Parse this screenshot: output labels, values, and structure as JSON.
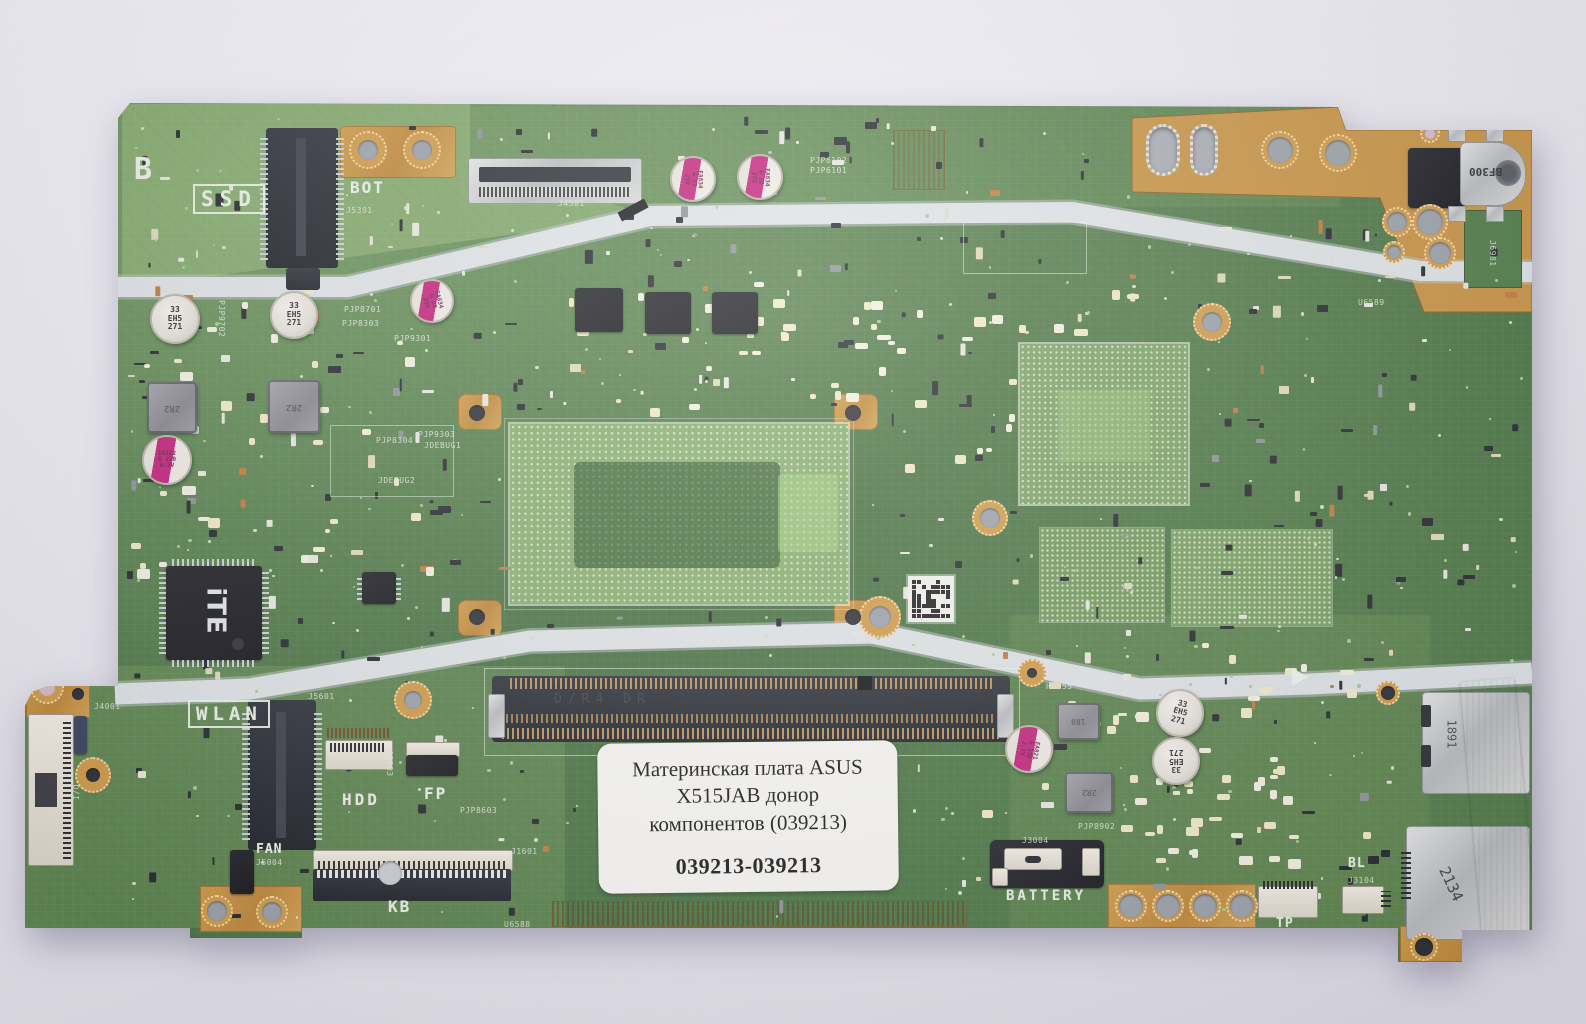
{
  "photo": {
    "background_top": "#f1f0f6",
    "background_bottom": "#dddbe4",
    "pcb_green": "#4a7342",
    "copper": "#c6913f",
    "band_metal": "#dde2e4"
  },
  "label": {
    "line1": "Материнская плата ASUS",
    "line2": "X515JAB донор",
    "line3": "компонентов (039213)",
    "code": "039213-039213"
  },
  "markings": {
    "dc_jack": "BF300",
    "usb_top": "1891",
    "usb_bottom": "2134",
    "ec_logo": "iTE",
    "ram": "D/R4 DR"
  },
  "silkscreen": {
    "big": [
      {
        "text": "B",
        "x": 134,
        "y": 152,
        "size": 30,
        "ls": 0,
        "box": false,
        "rot": 0
      },
      {
        "text": "SSD",
        "x": 193,
        "y": 184,
        "size": 21,
        "ls": 6,
        "box": true,
        "rot": 0
      },
      {
        "text": "BOT",
        "x": 350,
        "y": 178,
        "size": 16,
        "ls": 2,
        "box": false,
        "rot": 0
      },
      {
        "text": "WLAN",
        "x": 188,
        "y": 700,
        "size": 19,
        "ls": 5,
        "box": true,
        "rot": 0
      },
      {
        "text": "HDD",
        "x": 342,
        "y": 790,
        "size": 16,
        "ls": 3,
        "box": false,
        "rot": 0
      },
      {
        "text": "FP",
        "x": 424,
        "y": 784,
        "size": 16,
        "ls": 2,
        "box": false,
        "rot": 0
      },
      {
        "text": "KB",
        "x": 388,
        "y": 897,
        "size": 16,
        "ls": 2,
        "box": false,
        "rot": 0
      },
      {
        "text": "FAN",
        "x": 256,
        "y": 842,
        "size": 13,
        "ls": 1,
        "box": false,
        "rot": 0
      },
      {
        "text": "BATTERY",
        "x": 1006,
        "y": 888,
        "size": 14,
        "ls": 3,
        "box": false,
        "rot": 0
      },
      {
        "text": "TP",
        "x": 1276,
        "y": 916,
        "size": 13,
        "ls": 1,
        "box": false,
        "rot": 0
      },
      {
        "text": "BL",
        "x": 1348,
        "y": 856,
        "size": 13,
        "ls": 1,
        "box": false,
        "rot": 0
      }
    ],
    "refdes": [
      {
        "text": "J5301",
        "x": 346,
        "y": 206,
        "rot": 0
      },
      {
        "text": "J4501",
        "x": 558,
        "y": 199,
        "rot": 0
      },
      {
        "text": "PJP6102",
        "x": 810,
        "y": 156,
        "rot": 0
      },
      {
        "text": "PJP6101",
        "x": 810,
        "y": 166,
        "rot": 0
      },
      {
        "text": "PJP8201",
        "x": 402,
        "y": 264,
        "rot": 0
      },
      {
        "text": "PJP8701",
        "x": 344,
        "y": 305,
        "rot": 0
      },
      {
        "text": "PJP8303",
        "x": 342,
        "y": 319,
        "rot": 0
      },
      {
        "text": "PJP9301",
        "x": 394,
        "y": 334,
        "rot": 0
      },
      {
        "text": "PJP9702",
        "x": 226,
        "y": 300,
        "rot": 90
      },
      {
        "text": "PJP8304",
        "x": 376,
        "y": 436,
        "rot": 0
      },
      {
        "text": "PJP9303",
        "x": 418,
        "y": 430,
        "rot": 0
      },
      {
        "text": "JDEBUG1",
        "x": 424,
        "y": 441,
        "rot": 0
      },
      {
        "text": "JDEBUG2",
        "x": 378,
        "y": 476,
        "rot": 0
      },
      {
        "text": "J4001",
        "x": 94,
        "y": 702,
        "rot": 0
      },
      {
        "text": "I/O",
        "x": 72,
        "y": 800,
        "rot": -90
      },
      {
        "text": "J5601",
        "x": 308,
        "y": 692,
        "rot": 0
      },
      {
        "text": "J3103",
        "x": 394,
        "y": 750,
        "rot": 90
      },
      {
        "text": "PJP8603",
        "x": 460,
        "y": 806,
        "rot": 0
      },
      {
        "text": "J5004",
        "x": 256,
        "y": 858,
        "rot": 0
      },
      {
        "text": "J1601",
        "x": 511,
        "y": 847,
        "rot": 0
      },
      {
        "text": "U6588",
        "x": 504,
        "y": 920,
        "rot": 0
      },
      {
        "text": "H6555",
        "x": 1046,
        "y": 682,
        "rot": 0
      },
      {
        "text": "H6557",
        "x": 1196,
        "y": 230,
        "rot": 0
      },
      {
        "text": "U6589",
        "x": 1358,
        "y": 298,
        "rot": 0
      },
      {
        "text": "PJP8902",
        "x": 1078,
        "y": 822,
        "rot": 0
      },
      {
        "text": "J3004",
        "x": 1022,
        "y": 836,
        "rot": 0
      },
      {
        "text": "J3104",
        "x": 1348,
        "y": 876,
        "rot": 0
      },
      {
        "text": "J6981",
        "x": 1497,
        "y": 240,
        "rot": 90
      }
    ]
  },
  "components": {
    "caps": [
      {
        "x": 691,
        "y": 177,
        "r": 21,
        "type": "pink",
        "lines": [
          "EA834",
          "G 22",
          "25V"
        ],
        "rot": 90
      },
      {
        "x": 758,
        "y": 175,
        "r": 21,
        "type": "pink",
        "lines": [
          "EA834",
          "G 22",
          "25V"
        ],
        "rot": 90
      },
      {
        "x": 430,
        "y": 299,
        "r": 20,
        "type": "pink",
        "lines": [
          "EA834",
          "G 22",
          "25V"
        ],
        "rot": 75
      },
      {
        "x": 165,
        "y": 458,
        "r": 23,
        "type": "pink",
        "lines": [
          "EA322",
          "G 220",
          "6.3V"
        ],
        "rot": 0
      },
      {
        "x": 1027,
        "y": 747,
        "r": 22,
        "type": "pink",
        "lines": [
          "EA821",
          "G 330",
          "2.5V"
        ],
        "rot": 100
      },
      {
        "x": 173,
        "y": 317,
        "r": 23,
        "type": "white",
        "lines": [
          "33",
          "EH5",
          "271"
        ],
        "rot": 0
      },
      {
        "x": 292,
        "y": 313,
        "r": 22,
        "type": "white",
        "lines": [
          "33",
          "EH5",
          "271"
        ],
        "rot": 0
      },
      {
        "x": 1178,
        "y": 711,
        "r": 22,
        "type": "white",
        "lines": [
          "33",
          "EH5",
          "271"
        ],
        "rot": 15
      },
      {
        "x": 1174,
        "y": 759,
        "r": 22,
        "type": "white",
        "lines": [
          "33",
          "EH5",
          "271"
        ],
        "rot": 180
      }
    ],
    "holes": [
      {
        "x": 368,
        "y": 150,
        "r": 10,
        "ring": 9,
        "center": "grey"
      },
      {
        "x": 422,
        "y": 150,
        "r": 10,
        "ring": 9,
        "center": "grey"
      },
      {
        "x": 880,
        "y": 617,
        "r": 11,
        "ring": 10,
        "center": "grey"
      },
      {
        "x": 413,
        "y": 700,
        "r": 9,
        "ring": 10,
        "center": "grey"
      },
      {
        "x": 1032,
        "y": 673,
        "r": 5,
        "ring": 9,
        "center": "dark"
      },
      {
        "x": 47,
        "y": 687,
        "r": 9,
        "ring": 8,
        "center": "pink"
      },
      {
        "x": 78,
        "y": 694,
        "r": 6,
        "ring": 0,
        "center": "dark"
      },
      {
        "x": 217,
        "y": 911,
        "r": 10,
        "ring": 6,
        "center": "grey"
      },
      {
        "x": 272,
        "y": 912,
        "r": 10,
        "ring": 6,
        "center": "grey"
      },
      {
        "x": 390,
        "y": 873,
        "r": 12,
        "ring": 0,
        "center": "lgrey"
      },
      {
        "x": 1212,
        "y": 322,
        "r": 10,
        "ring": 9,
        "center": "grey"
      },
      {
        "x": 990,
        "y": 518,
        "r": 10,
        "ring": 8,
        "center": "grey"
      },
      {
        "x": 1388,
        "y": 693,
        "r": 7,
        "ring": 5,
        "center": "dark"
      },
      {
        "x": 1424,
        "y": 947,
        "r": 9,
        "ring": 5,
        "center": "dark"
      },
      {
        "x": 1280,
        "y": 150,
        "r": 13,
        "ring": 6,
        "center": "grey"
      },
      {
        "x": 1338,
        "y": 153,
        "r": 13,
        "ring": 6,
        "center": "grey"
      },
      {
        "x": 1397,
        "y": 222,
        "r": 10,
        "ring": 5,
        "center": "grey"
      },
      {
        "x": 1430,
        "y": 222,
        "r": 13,
        "ring": 5,
        "center": "grey"
      },
      {
        "x": 1394,
        "y": 252,
        "r": 7,
        "ring": 4,
        "center": "grey"
      },
      {
        "x": 1440,
        "y": 253,
        "r": 11,
        "ring": 5,
        "center": "grey"
      },
      {
        "x": 1430,
        "y": 133,
        "r": 6,
        "ring": 4,
        "center": "pink"
      },
      {
        "x": 93,
        "y": 775,
        "r": 7,
        "ring": 11,
        "center": "dark"
      },
      {
        "x": 1131,
        "y": 906,
        "r": 12,
        "ring": 4,
        "center": "grey"
      },
      {
        "x": 1168,
        "y": 906,
        "r": 12,
        "ring": 4,
        "center": "grey"
      },
      {
        "x": 1205,
        "y": 906,
        "r": 12,
        "ring": 4,
        "center": "grey"
      },
      {
        "x": 1242,
        "y": 906,
        "r": 12,
        "ring": 4,
        "center": "grey"
      },
      {
        "x": 477,
        "y": 413,
        "r": 8,
        "ring": 0,
        "center": "dark"
      },
      {
        "x": 853,
        "y": 413,
        "r": 8,
        "ring": 0,
        "center": "dark"
      },
      {
        "x": 477,
        "y": 617,
        "r": 8,
        "ring": 0,
        "center": "dark"
      },
      {
        "x": 853,
        "y": 617,
        "r": 8,
        "ring": 0,
        "center": "dark"
      }
    ],
    "oval_holes": [
      {
        "x": 1146,
        "y": 124,
        "w": 34,
        "h": 52
      },
      {
        "x": 1190,
        "y": 124,
        "w": 28,
        "h": 52
      }
    ]
  }
}
